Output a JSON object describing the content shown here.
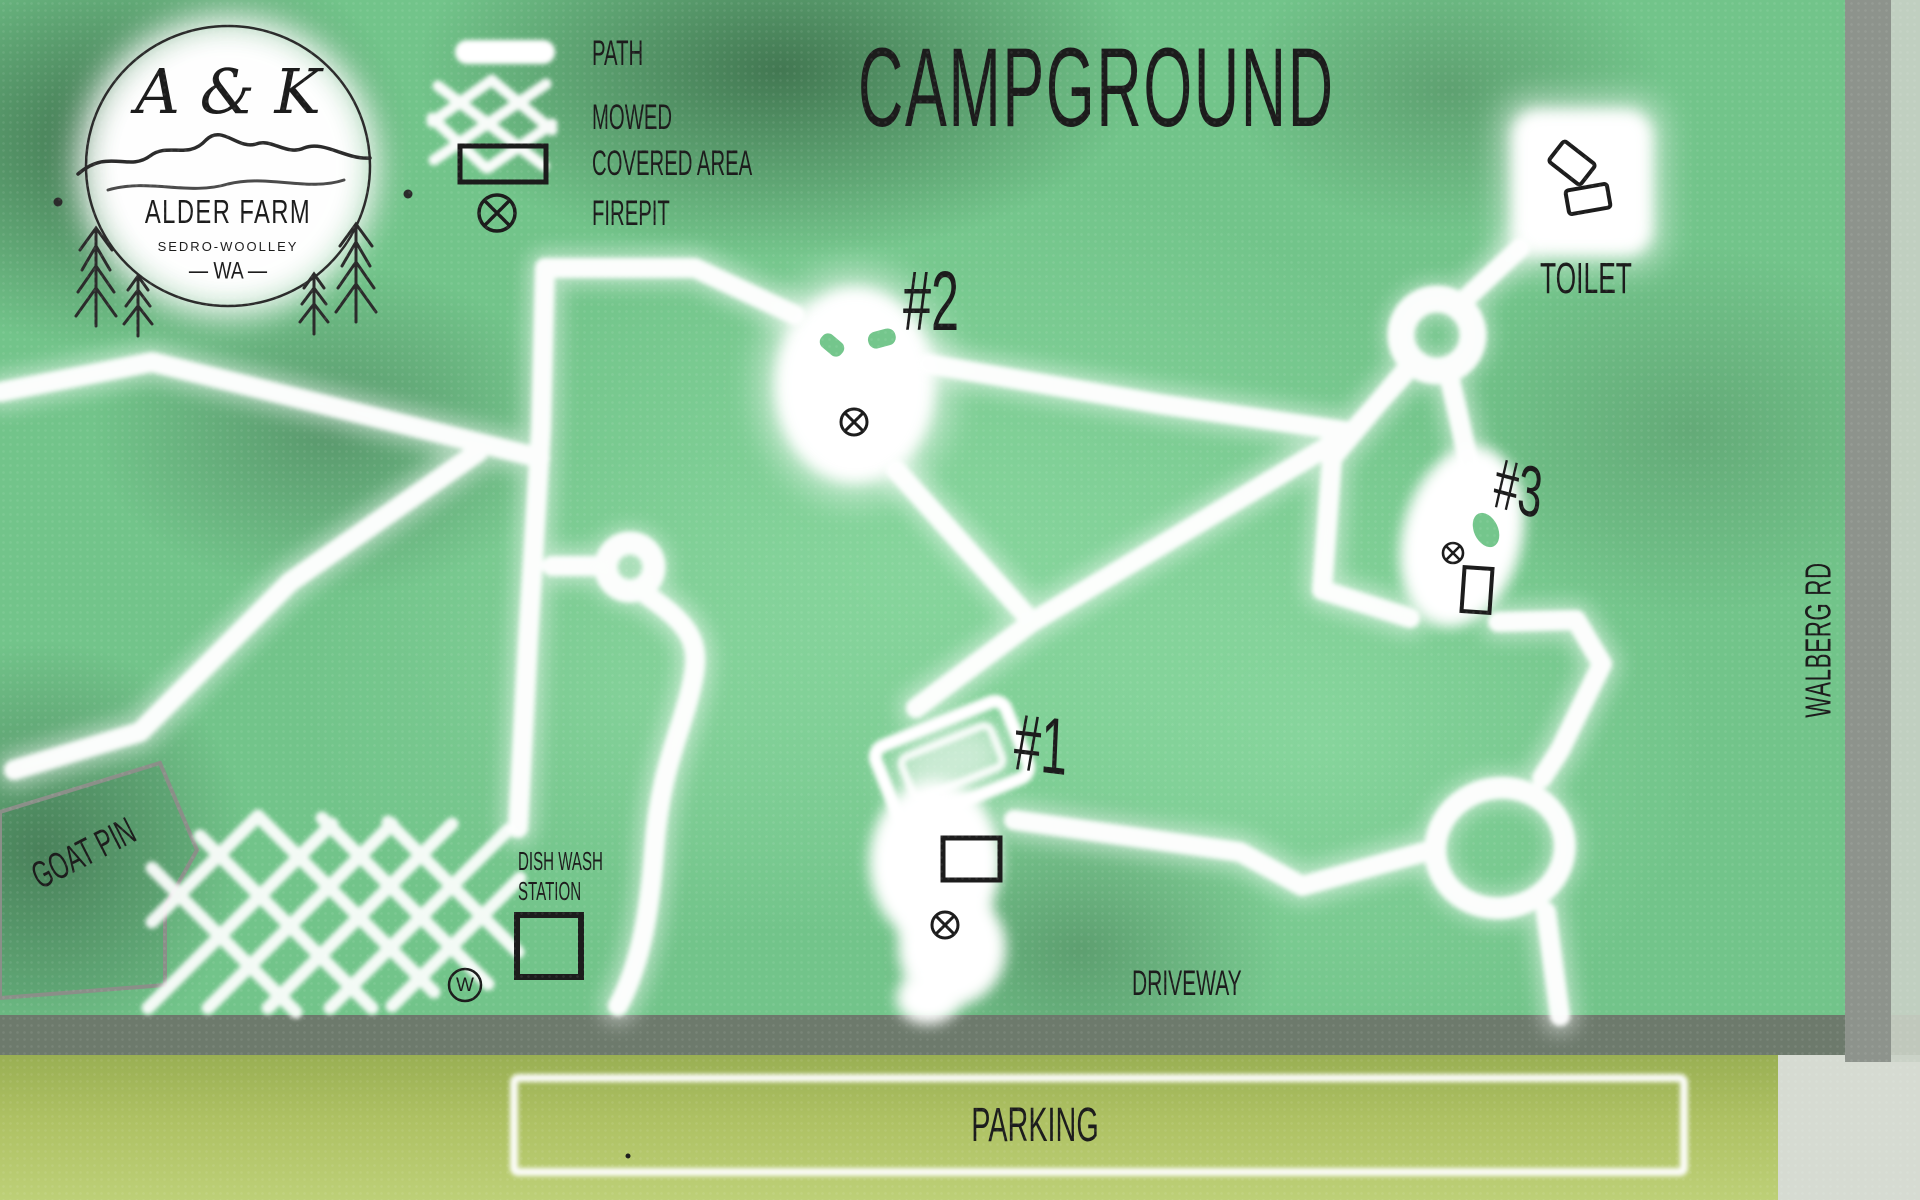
{
  "map": {
    "title": "CAMPGROUND"
  },
  "logo": {
    "initials": "A & K",
    "farm_name": "ALDER FARM",
    "city": "SEDRO-WOOLLEY",
    "state_line": "— WA —"
  },
  "legend": {
    "items": [
      {
        "label": "PATH"
      },
      {
        "label": "MOWED"
      },
      {
        "label": "COVERED AREA"
      },
      {
        "label": "FIREPIT"
      }
    ]
  },
  "sites": [
    {
      "label": "#1"
    },
    {
      "label": "#2"
    },
    {
      "label": "#3"
    }
  ],
  "labels": {
    "toilet": "TOILET",
    "road": "WALBERG RD",
    "driveway": "DRIVEWAY",
    "parking": "PARKING",
    "goat_pin": "GOAT PIN",
    "dish_wash_line1": "DISH WASH",
    "dish_wash_line2": "STATION",
    "water": "W"
  },
  "colors": {
    "ink": "#1c1c1c",
    "path": "#ffffff",
    "driveway_gray": "#6d7a6c",
    "road_gray": "#8d938c",
    "parking_green": "#b3c76a",
    "background_green": "#72c48a"
  }
}
